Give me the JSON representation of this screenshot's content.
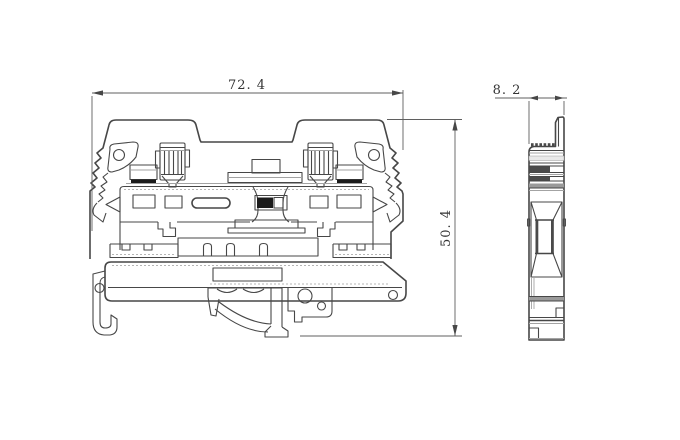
{
  "drawing": {
    "type": "technical-drawing",
    "subject": "din-rail-terminal-block",
    "views": [
      {
        "id": "front",
        "name": "front view"
      },
      {
        "id": "side",
        "name": "side view"
      }
    ],
    "dimension_labels": {
      "width": "72. 4",
      "height": "50. 4",
      "thickness": "8. 2"
    },
    "colors": {
      "line": "#474747",
      "dark_fill": "#1b1b1b",
      "texture": "#9a9a9a",
      "background": "#ffffff"
    }
  }
}
